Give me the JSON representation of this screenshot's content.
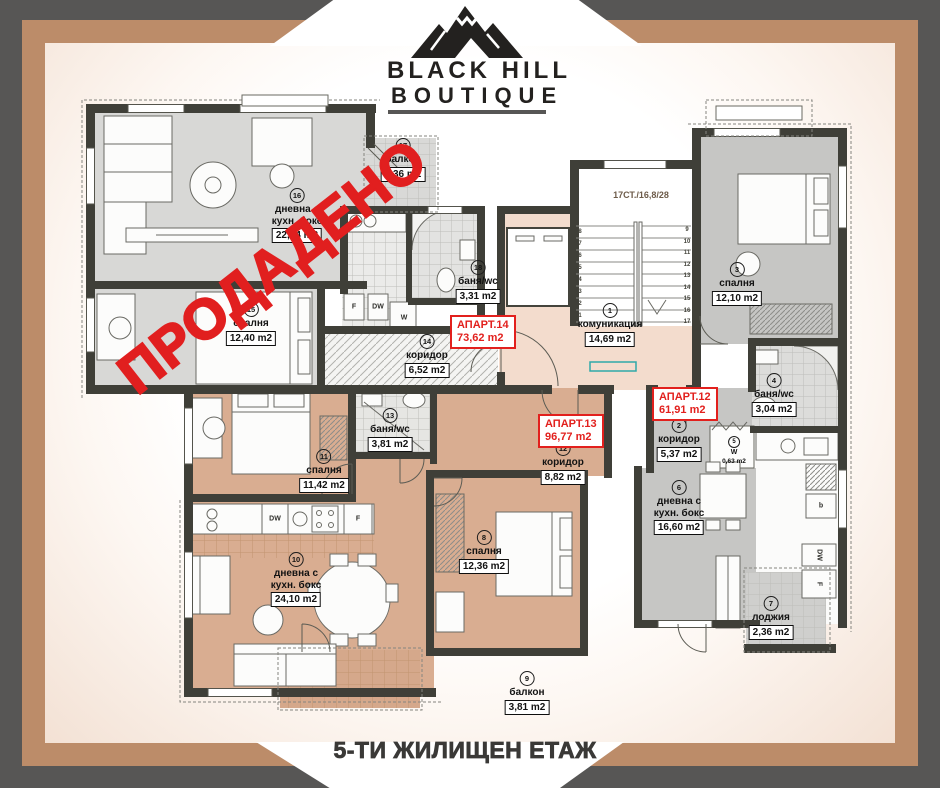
{
  "logo": {
    "line1": "BLACK HILL",
    "line2": "BOUTIQUE"
  },
  "footer": {
    "title": "5-ТИ ЖИЛИЩЕН ЕТАЖ"
  },
  "sold_stamp": "ПРОДАДЕНО",
  "stairs_label": "17СТ./16,8/28",
  "stairs_steps": 17,
  "apartments": [
    {
      "id": "apart-12",
      "label": "АПАРТ.12",
      "area": "61,91 m2"
    },
    {
      "id": "apart-13",
      "label": "АПАРТ.13",
      "area": "96,77 m2"
    },
    {
      "id": "apart-14",
      "label": "АПАРТ.14",
      "area": "73,62 m2"
    }
  ],
  "rooms": [
    {
      "num": "1",
      "name": [
        "комуникация"
      ],
      "area": "14,69 m2"
    },
    {
      "num": "2",
      "name": [
        "коридор"
      ],
      "area": "5,37 m2"
    },
    {
      "num": "3",
      "name": [
        "спалня"
      ],
      "area": "12,10 m2"
    },
    {
      "num": "4",
      "name": [
        "баня/wc"
      ],
      "area": "3,04 m2"
    },
    {
      "num": "5",
      "name": [
        "W"
      ],
      "area": "0,63 m2"
    },
    {
      "num": "6",
      "name": [
        "дневна с",
        "кухн. бокс"
      ],
      "area": "16,60 m2"
    },
    {
      "num": "7",
      "name": [
        "лоджия"
      ],
      "area": "2,36 m2"
    },
    {
      "num": "8",
      "name": [
        "спалня"
      ],
      "area": "12,36 m2"
    },
    {
      "num": "9",
      "name": [
        "балкон"
      ],
      "area": "3,81 m2"
    },
    {
      "num": "10",
      "name": [
        "дневна с",
        "кухн. бокс"
      ],
      "area": "24,10 m2"
    },
    {
      "num": "11",
      "name": [
        "спалня"
      ],
      "area": "11,42 m2"
    },
    {
      "num": "12",
      "name": [
        "коридор"
      ],
      "area": "8,82 m2"
    },
    {
      "num": "13",
      "name": [
        "баня/wc"
      ],
      "area": "3,81 m2"
    },
    {
      "num": "14",
      "name": [
        "коридор"
      ],
      "area": "6,52 m2"
    },
    {
      "num": "15",
      "name": [
        "спалня"
      ],
      "area": "12,40 m2"
    },
    {
      "num": "16",
      "name": [
        "дневна с",
        "кухн. бокс"
      ],
      "area": "22,34 m2"
    },
    {
      "num": "17",
      "name": [
        "балкон"
      ],
      "area": "2,36 m2"
    },
    {
      "num": "18",
      "name": [
        "баня/wc"
      ],
      "area": "3,31 m2"
    }
  ],
  "appliances": {
    "fridge": "F",
    "dishwasher": "DW",
    "washer": "W",
    "boiler": "b"
  },
  "colors": {
    "frame_outer": "#575655",
    "frame_inner": "#bc8c69",
    "accent_red": "#e2201d",
    "wall": "#3f3f38",
    "apartment14_fill": "#d8d8d6",
    "apartment13_fill": "#d9ad91",
    "apartment12_fill": "#c6c6c4",
    "landing_fill": "#f3dccd"
  }
}
